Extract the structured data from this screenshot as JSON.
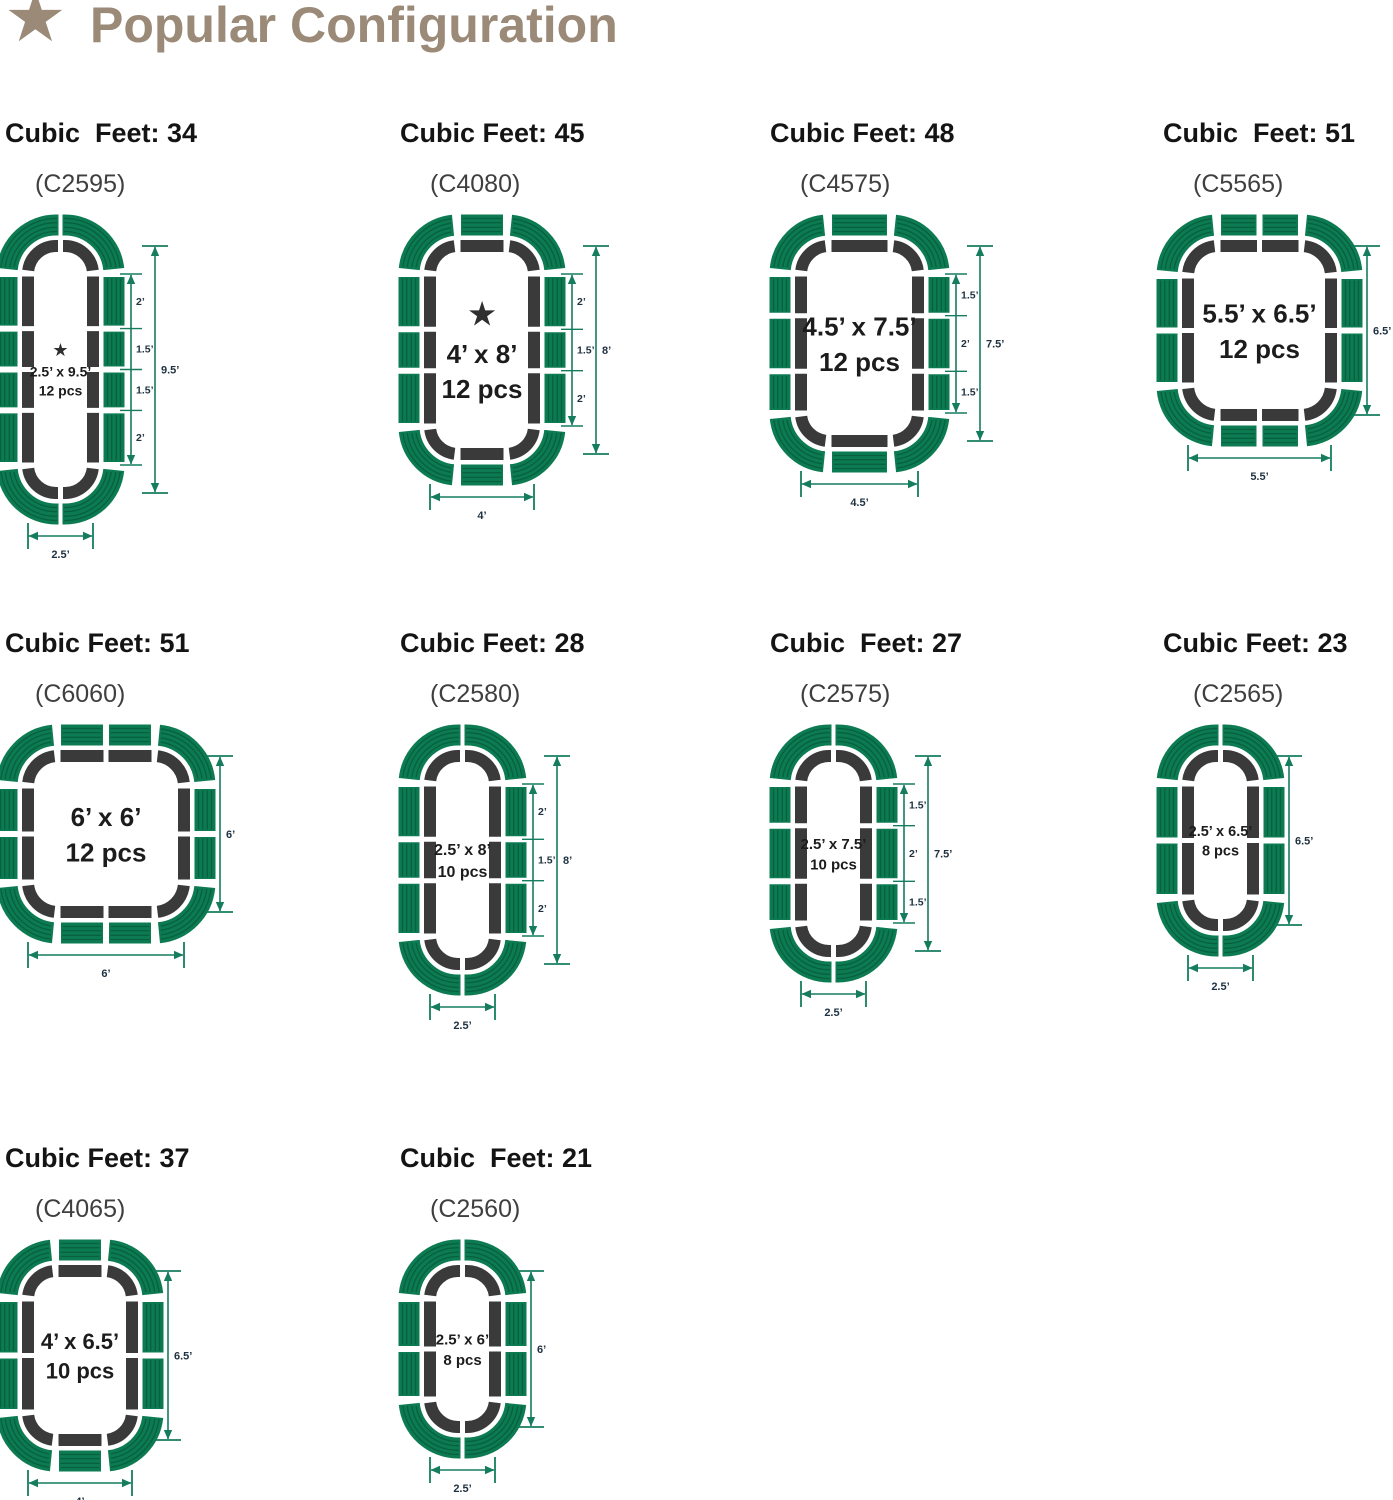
{
  "title": {
    "text": "Popular Configuration"
  },
  "glyphs": {
    "star": "★"
  },
  "colors": {
    "title": "#9b8a78",
    "heading_text": "#141414",
    "model_text": "#3f3f3f",
    "panel_green": "#0c7b52",
    "panel_ridge": "#07603f",
    "outline_dark": "#3a3a3a",
    "bed_text": "#1c1c1c",
    "bed_star": "#2f2f2f",
    "dim_line": "#157d5e",
    "dim_text": "#1e3140"
  },
  "configs": [
    {
      "cubic_feet_label": "Cubic  Feet: 34",
      "model_label": "(C2595)",
      "size_label": "2.5’ x 9.5’",
      "pcs_label": "12 pcs",
      "starred": true,
      "bed_width_ft": 2.5,
      "bed_height_ft": 9.5,
      "side_panel_count": 4,
      "end_panel_count": 0,
      "side_segment_labels": [
        "2’",
        "1.5’",
        "1.5’",
        "2’"
      ],
      "total_height_label": "9.5’",
      "bottom_width_label": "2.5’"
    },
    {
      "cubic_feet_label": "Cubic Feet: 45",
      "model_label": "(C4080)",
      "size_label": "4’ x 8’",
      "pcs_label": "12 pcs",
      "starred": true,
      "bed_width_ft": 4,
      "bed_height_ft": 8,
      "side_panel_count": 3,
      "end_panel_count": 1,
      "side_segment_labels": [
        "2’",
        "1.5’",
        "2’"
      ],
      "total_height_label": "8’",
      "bottom_width_label": "4’"
    },
    {
      "cubic_feet_label": "Cubic Feet: 48",
      "model_label": "(C4575)",
      "size_label": "4.5’ x 7.5’",
      "pcs_label": "12 pcs",
      "starred": false,
      "bed_width_ft": 4.5,
      "bed_height_ft": 7.5,
      "side_panel_count": 3,
      "end_panel_count": 1,
      "side_segment_labels": [
        "1.5’",
        "2’",
        "1.5’"
      ],
      "total_height_label": "7.5’",
      "bottom_width_label": "4.5’"
    },
    {
      "cubic_feet_label": "Cubic  Feet: 51",
      "model_label": "(C5565)",
      "size_label": "5.5’ x 6.5’",
      "pcs_label": "12 pcs",
      "starred": false,
      "bed_width_ft": 5.5,
      "bed_height_ft": 6.5,
      "side_panel_count": 2,
      "end_panel_count": 2,
      "side_segment_labels": [],
      "total_height_label": "6.5’",
      "bottom_width_label": "5.5’"
    },
    {
      "cubic_feet_label": "Cubic Feet: 51",
      "model_label": "(C6060)",
      "size_label": "6’ x 6’",
      "pcs_label": "12 pcs",
      "starred": false,
      "bed_width_ft": 6,
      "bed_height_ft": 6,
      "side_panel_count": 2,
      "end_panel_count": 2,
      "side_segment_labels": [],
      "total_height_label": "6’",
      "bottom_width_label": "6’"
    },
    {
      "cubic_feet_label": "Cubic Feet: 28",
      "model_label": "(C2580)",
      "size_label": "2.5’ x 8’",
      "pcs_label": "10 pcs",
      "starred": false,
      "bed_width_ft": 2.5,
      "bed_height_ft": 8,
      "side_panel_count": 3,
      "end_panel_count": 0,
      "side_segment_labels": [
        "2’",
        "1.5’",
        "2’"
      ],
      "total_height_label": "8’",
      "bottom_width_label": "2.5’"
    },
    {
      "cubic_feet_label": "Cubic  Feet: 27",
      "model_label": "(C2575)",
      "size_label": "2.5’ x 7.5’",
      "pcs_label": "10 pcs",
      "starred": false,
      "bed_width_ft": 2.5,
      "bed_height_ft": 7.5,
      "side_panel_count": 3,
      "end_panel_count": 0,
      "side_segment_labels": [
        "1.5’",
        "2’",
        "1.5’"
      ],
      "total_height_label": "7.5’",
      "bottom_width_label": "2.5’"
    },
    {
      "cubic_feet_label": "Cubic Feet: 23",
      "model_label": "(C2565)",
      "size_label": "2.5’ x 6.5’",
      "pcs_label": "8 pcs",
      "starred": false,
      "bed_width_ft": 2.5,
      "bed_height_ft": 6.5,
      "side_panel_count": 2,
      "end_panel_count": 0,
      "side_segment_labels": [],
      "total_height_label": "6.5’",
      "bottom_width_label": "2.5’"
    },
    {
      "cubic_feet_label": "Cubic Feet: 37",
      "model_label": "(C4065)",
      "size_label": "4’ x 6.5’",
      "pcs_label": "10 pcs",
      "starred": false,
      "bed_width_ft": 4,
      "bed_height_ft": 6.5,
      "side_panel_count": 2,
      "end_panel_count": 1,
      "side_segment_labels": [],
      "total_height_label": "6.5’",
      "bottom_width_label": "4’"
    },
    {
      "cubic_feet_label": "Cubic  Feet: 21",
      "model_label": "(C2560)",
      "size_label": "2.5’ x 6’",
      "pcs_label": "8 pcs",
      "starred": false,
      "bed_width_ft": 2.5,
      "bed_height_ft": 6,
      "side_panel_count": 2,
      "end_panel_count": 0,
      "side_segment_labels": [],
      "total_height_label": "6’",
      "bottom_width_label": "2.5’"
    }
  ]
}
